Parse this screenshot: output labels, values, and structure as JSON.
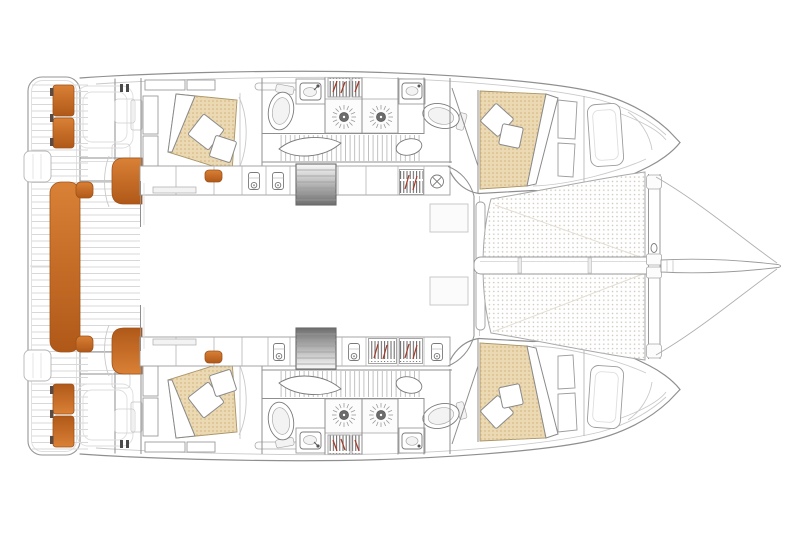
{
  "diagram": {
    "kind": "Catamaran interior deck plan, top view, bow to the right",
    "background": "#ffffff"
  },
  "colors": {
    "accent_orange": "#c96d2a",
    "accent_orange_light": "#d98136",
    "accent_orange_dark": "#b05818",
    "accent_outline": "#a0521a",
    "bed_fabric": "#ead9b2",
    "bed_fabric_dot": "#d2b27c",
    "trampoline_dot": "#ccc5b9",
    "line_strong": "#8f8f8f",
    "line_soft": "#c9c9c9",
    "hanger_red": "#a33a28",
    "steps_dark": "#6e6e6e"
  },
  "features": {
    "port_hull": [
      "aft-cabin-double-bed",
      "aft-head-toilet",
      "aft-head-washbasin",
      "shower-drains",
      "hanging-lockers",
      "companionway-corridor",
      "forward-cabin-double-bed",
      "forward-head-toilet",
      "forward-head-washbasin",
      "bow-storage-locker"
    ],
    "starboard_hull": [
      "aft-cabin-double-bed",
      "aft-head-toilet",
      "aft-head-washbasin",
      "shower-drains",
      "hanging-lockers",
      "companionway-corridor",
      "forward-cabin-double-bed",
      "forward-head-toilet",
      "forward-head-washbasin",
      "bow-storage-locker"
    ],
    "centerline": [
      "aft-swim-platform",
      "transom-seat-cushions",
      "aft-cockpit-bench",
      "cockpit-sole-planking",
      "saloon",
      "galley-units",
      "port-entry-steps",
      "starboard-entry-steps",
      "forward-cockpit-benches",
      "trampoline-net",
      "forward-crossbeam",
      "bowsprit",
      "bowsprit-bridles"
    ]
  }
}
